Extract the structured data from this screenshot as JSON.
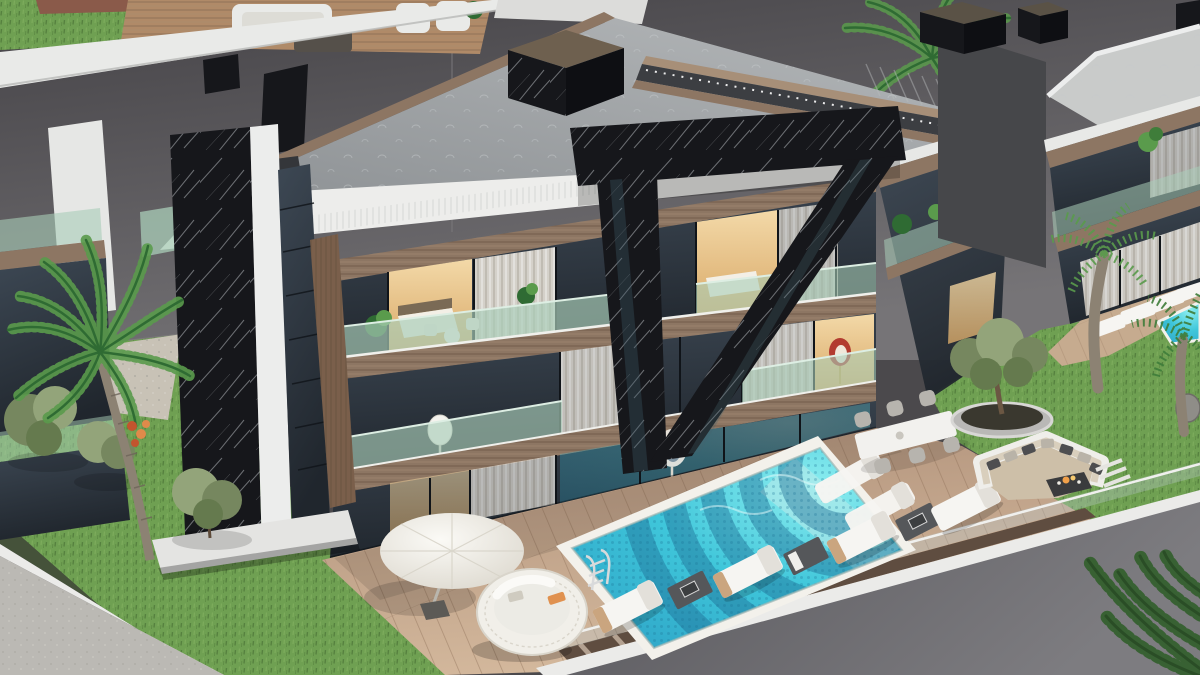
{
  "scene": {
    "title": "Aerial 3D render of a modern luxury villa with pool terrace",
    "view": "three-quarter aerial",
    "style": "contemporary architecture, black marble accents, wood and glass facade"
  },
  "palette": {
    "wall_top": "#454347",
    "wall_bottom": "#767477",
    "terrace_white": "#e9eae8",
    "terrace_deck": "#b08a68",
    "tile_red": "#8a5a4a",
    "lawn_light": "#6fa052",
    "lawn_dark": "#4e7c37",
    "blade1": "#41682e",
    "blade2": "#8ab665",
    "road": "#bbb9b4",
    "road_light": "#c6c4bf",
    "curb": "#ebebe9",
    "hedge": "#45523a",
    "gravel": "#c8c2b6",
    "roof_light": "#b6b9bb",
    "roof_dark": "#8e9295",
    "roof_speck": "#c6cacc",
    "fascia": "#ededeb",
    "louver": "#c9ccc9",
    "wood": "#8d7663",
    "wood_dark": "#64503f",
    "wood_light": "#a78f78",
    "wood_slat": "#7a5f4b",
    "marble": "#16171b",
    "marble_hi": "#2b2d34",
    "vein": "#d5d9de",
    "glass_top": "#3d4854",
    "glass_bottom": "#20262d",
    "glass_line": "#101419",
    "rail_green": "#a9cdb8",
    "rail_hi": "#ddeee3",
    "warm": "#d9a968",
    "warm_hi": "#f3d9a8",
    "curtain": "#e7e2d9",
    "curtain_hi": "#f6f3ed",
    "curtain_sh": "#ccc5b9",
    "pool_bright": "#8deef0",
    "pool_mid": "#3fc6da",
    "pool_deep": "#2b9fc4",
    "pool_wave": "#1d6a92",
    "mosaic": "#1a6e94",
    "coping": "#f3f1eb",
    "deck_light": "#d6bb9f",
    "deck_dark": "#b0917a",
    "plank": "#8d6f57",
    "walkway": "#5f4d40",
    "walkway_stripe": "#c9b6a4",
    "rwall_l": "#7d7c80",
    "rwall_d": "#56555a",
    "lounger": "#f6f5f2",
    "lounger_sh": "#e3e0da",
    "tbl_dark": "#55575a",
    "chair_gray": "#b7b4ae",
    "umbrella": "#f4f2ec",
    "umbrella_sh": "#ddd9cf",
    "wicker": "#f1efe9",
    "wicker_sh": "#d9d5cb",
    "towel": "#e0914f",
    "bench": "#efeeea",
    "cushion": "#d9cfbd",
    "pillow_d": "#4e4e50",
    "pillow_l": "#b9b3a8",
    "fire": "#3a3b3d",
    "flame": "#f0a04a",
    "planter": "#b9b8b6",
    "soil": "#3a382f",
    "olive1": "#76875f",
    "olive2": "#93a47a",
    "olive3": "#657a4e",
    "palm1": "#3f7d3a",
    "palm2": "#5a9b4c",
    "palm3": "#2f6b33",
    "palm_dark": "#35602f",
    "trunk": "#8c8273",
    "trunk_dark": "#6e655a",
    "fruit": "#c2552e",
    "fruit2": "#e08a4a",
    "red_chair": "#b23b30",
    "steel": "#d9dadb",
    "n_roof": "#c9cbca",
    "n_side": "#46474a",
    "pergola": "#3c3e42",
    "white": "#ffffff"
  },
  "objects": {
    "buildings": [
      "main villa (3 floors, black marble blades, wood and glass)",
      "left rooftop terrace with sofas",
      "right neighbor villa with deck and small pool"
    ],
    "pool_area": [
      "turquoise mosaic pool with wave pattern",
      "two in-pool loungers",
      "pool ladder",
      "four sun loungers with side tables",
      "outdoor dining table with six chairs",
      "white parasol",
      "round rattan daybed",
      "wooden deck",
      "glass railing over retaining wall"
    ],
    "garden": [
      "sunken lounge with fire table",
      "round planter with olive tree",
      "lawns",
      "palm trees",
      "shrubs",
      "gravel path",
      "street corner with curb"
    ]
  }
}
